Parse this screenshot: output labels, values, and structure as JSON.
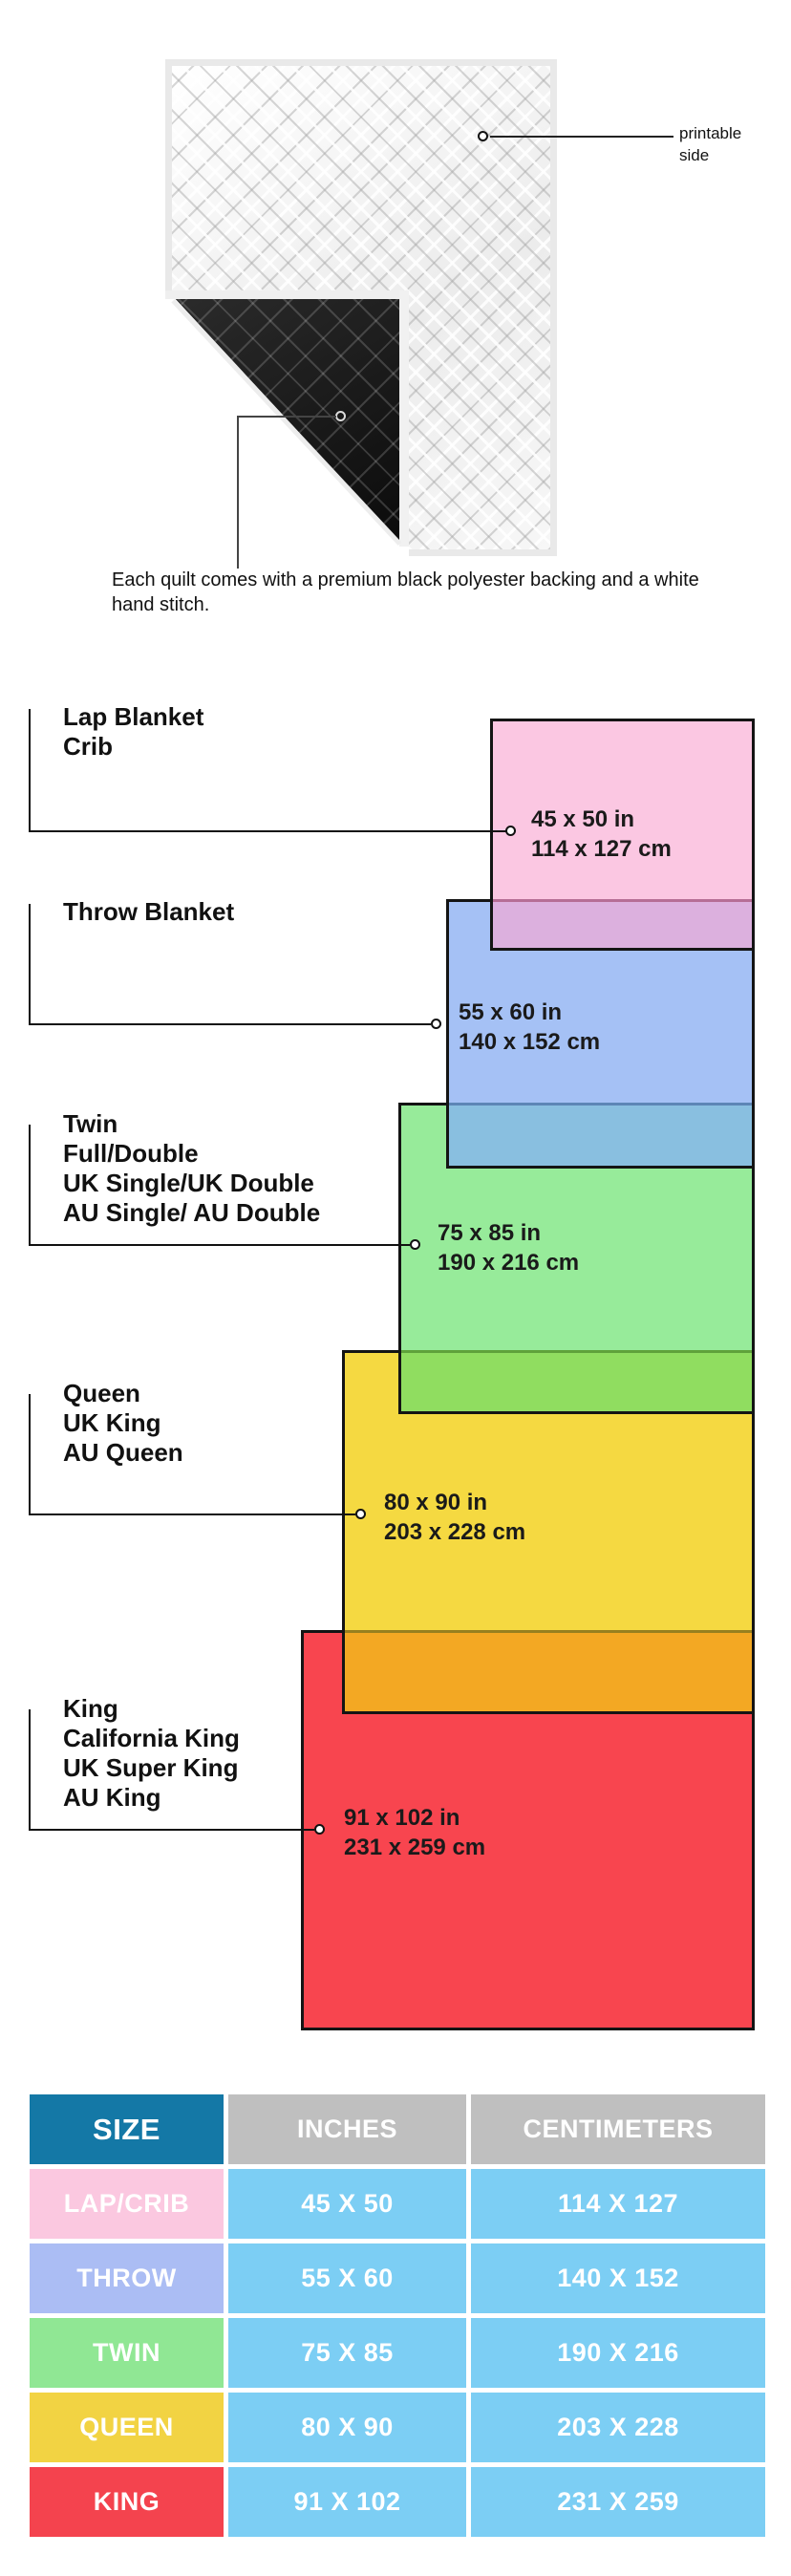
{
  "quilt": {
    "printable_label": "printable side",
    "caption": "Each quilt comes with a premium black polyester backing and a white hand stitch."
  },
  "diagram": {
    "sizes": [
      {
        "names": [
          "Lap Blanket",
          "Crib"
        ],
        "inches": "45 x 50 in",
        "cm": "114 x 127 cm",
        "fill": "#fbc7e2",
        "overlap_fill": "#dcb0de"
      },
      {
        "names": [
          "Throw Blanket"
        ],
        "inches": "55 x 60 in",
        "cm": "140 x 152 cm",
        "fill": "#a5c1f5",
        "overlap_fill": "#89bfe0"
      },
      {
        "names": [
          "Twin",
          "Full/Double",
          "UK Single/UK Double",
          "AU Single/ AU Double"
        ],
        "inches": "75 x 85 in",
        "cm": "190 x 216 cm",
        "fill": "#97eb9a",
        "overlap_fill": "#90dd60"
      },
      {
        "names": [
          "Queen",
          "UK King",
          "AU Queen"
        ],
        "inches": "80 x 90 in",
        "cm": "203 x 228 cm",
        "fill": "#f5d941",
        "overlap_fill": "#f3a823"
      },
      {
        "names": [
          "King",
          "California King",
          "UK Super King",
          "AU King"
        ],
        "inches": "91 x 102 in",
        "cm": "231 x 259 cm",
        "fill": "#f8454f",
        "overlap_fill": ""
      }
    ],
    "border_color": "#141414"
  },
  "table": {
    "headers": [
      "SIZE",
      "INCHES",
      "CENTIMETERS"
    ],
    "header_colors": {
      "size": "#1478a6",
      "others": "#bfbfbf"
    },
    "data_cell_color": "#7ccef4",
    "rows": [
      {
        "size": "LAP/CRIB",
        "inches": "45 X 50",
        "cm": "114 X 127",
        "color": "#fbc8e0"
      },
      {
        "size": "THROW",
        "inches": "55 X 60",
        "cm": "140 X 152",
        "color": "#abbdf4"
      },
      {
        "size": "TWIN",
        "inches": "75 X 85",
        "cm": "190 X 216",
        "color": "#90e794"
      },
      {
        "size": "QUEEN",
        "inches": "80 X 90",
        "cm": "203 X 228",
        "color": "#f2d343"
      },
      {
        "size": "KING",
        "inches": "91 X 102",
        "cm": "231 X 259",
        "color": "#f4434e"
      }
    ]
  }
}
